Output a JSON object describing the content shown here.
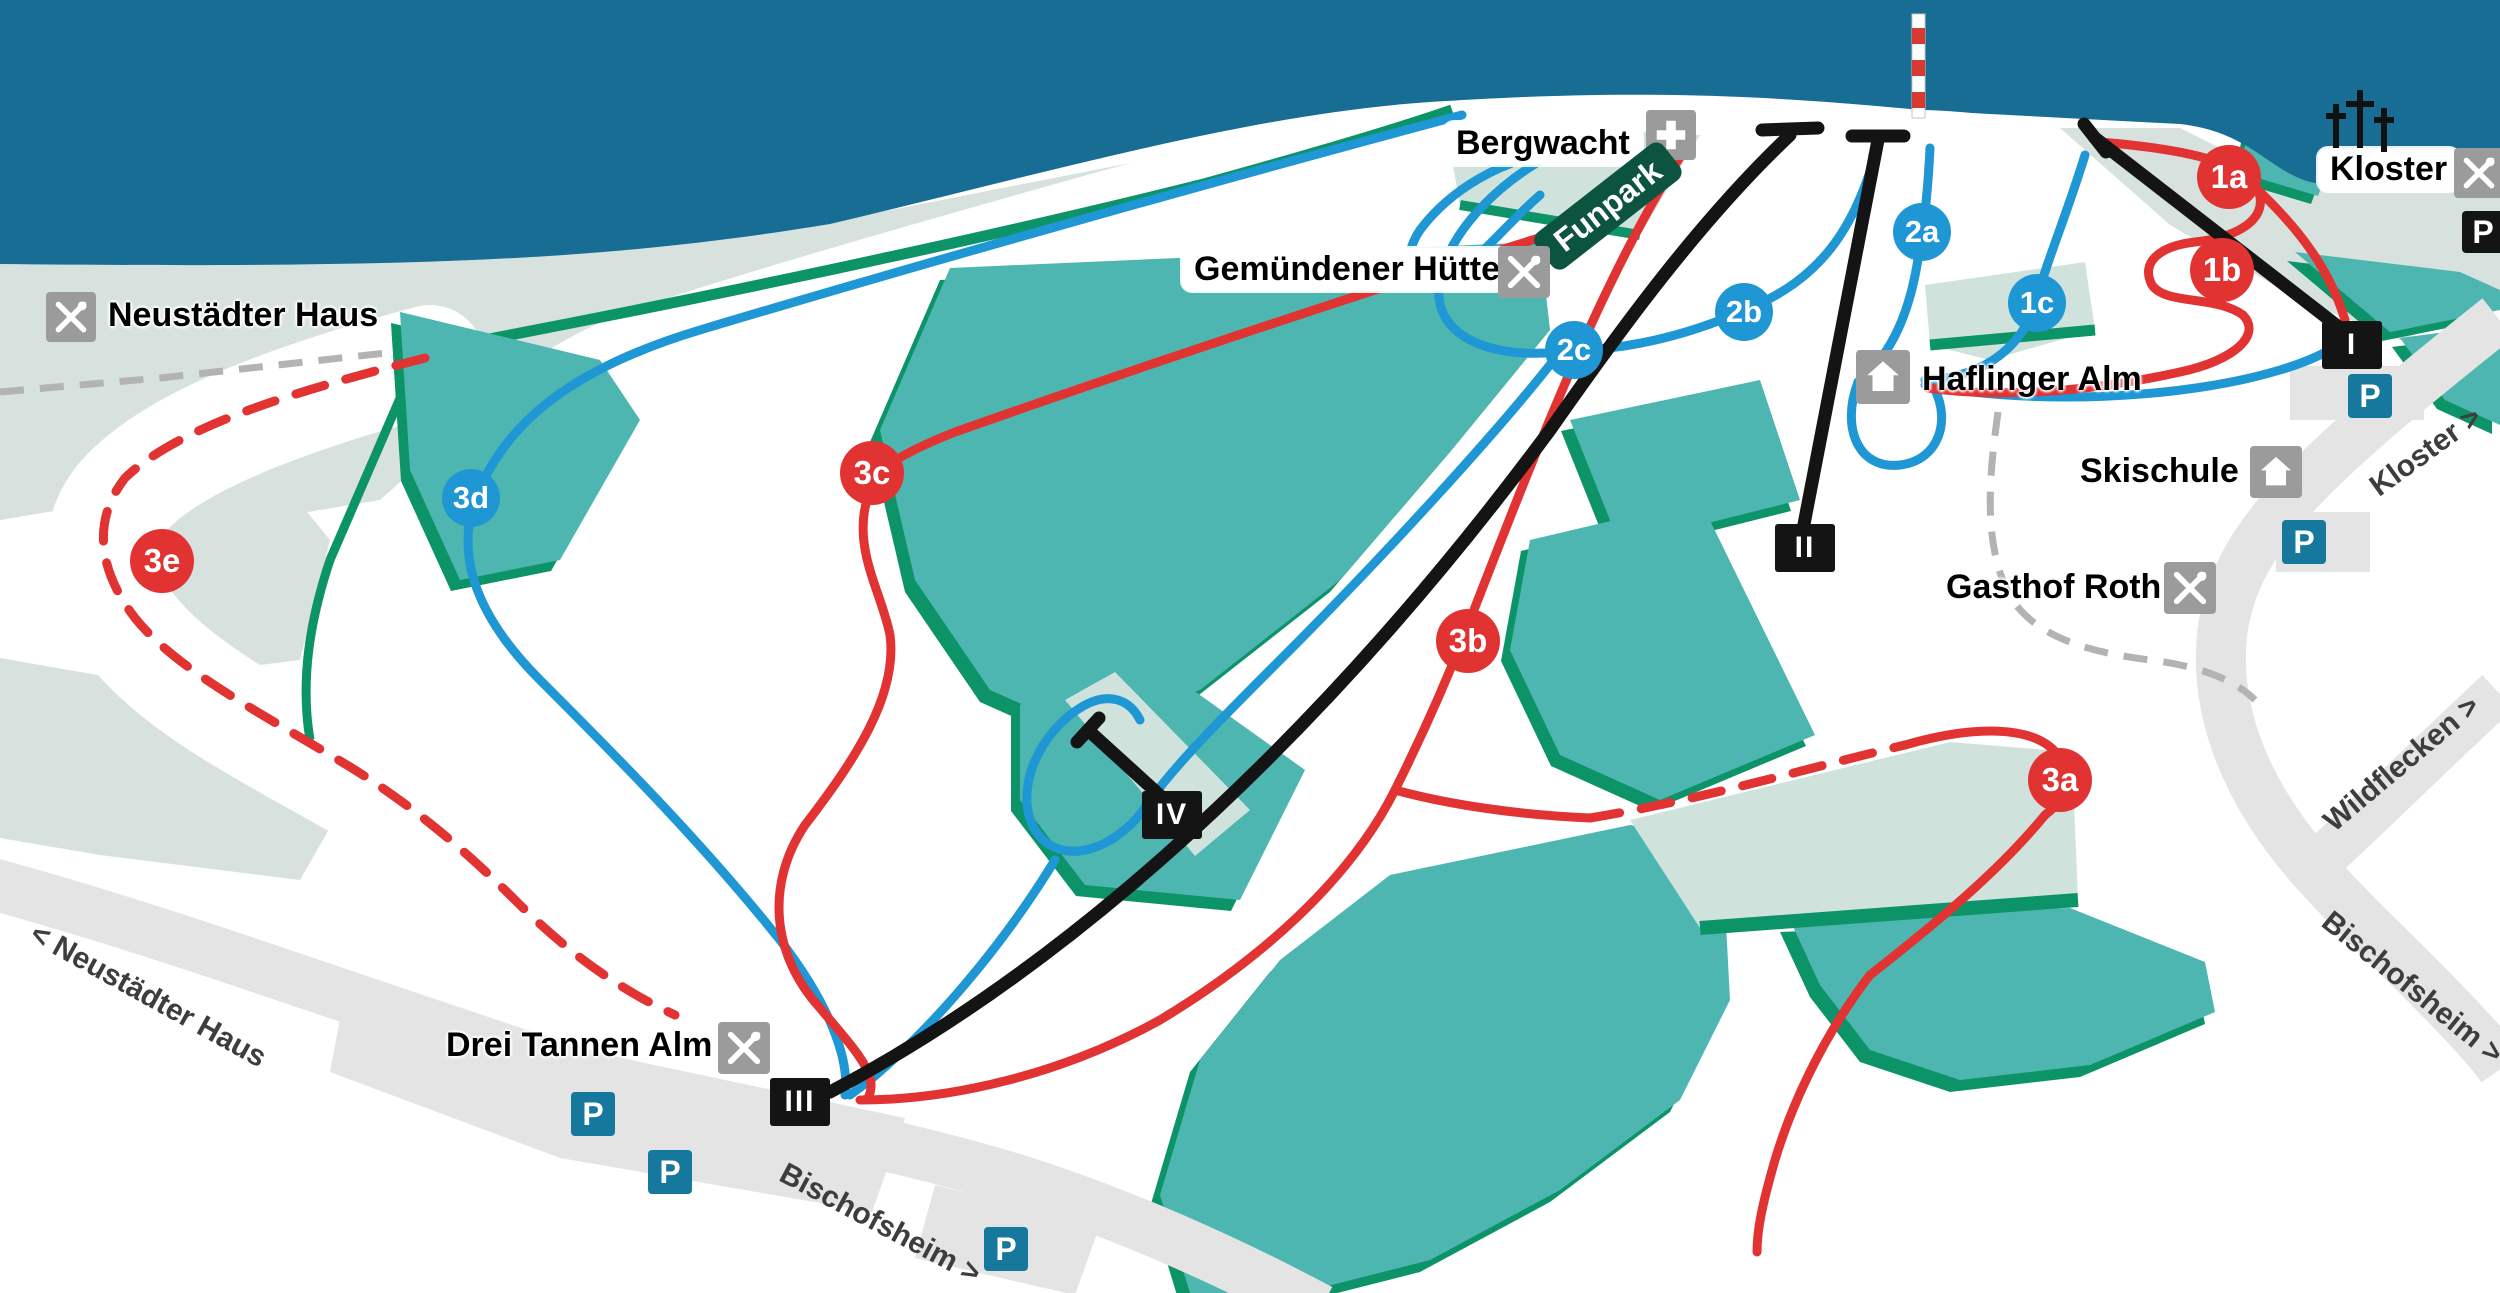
{
  "places": {
    "neustaedter_haus": "Neustädter Haus",
    "bergwacht": "Bergwacht",
    "funpark": "Funpark",
    "gemuendener_huette": "Gemündener Hütte",
    "haflinger_alm": "Haflinger Alm",
    "skischule": "Skischule",
    "gasthof_roth": "Gasthof Roth",
    "kloster": "Kloster",
    "drei_tannen_alm": "Drei Tannen Alm"
  },
  "pistes": [
    {
      "label": "1a",
      "difficulty": "red"
    },
    {
      "label": "1b",
      "difficulty": "red"
    },
    {
      "label": "1c",
      "difficulty": "blue"
    },
    {
      "label": "2a",
      "difficulty": "blue"
    },
    {
      "label": "2b",
      "difficulty": "blue"
    },
    {
      "label": "2c",
      "difficulty": "blue"
    },
    {
      "label": "3a",
      "difficulty": "red"
    },
    {
      "label": "3b",
      "difficulty": "red"
    },
    {
      "label": "3c",
      "difficulty": "red"
    },
    {
      "label": "3d",
      "difficulty": "blue"
    },
    {
      "label": "3e",
      "difficulty": "red"
    }
  ],
  "lifts": [
    {
      "label": "I"
    },
    {
      "label": "II"
    },
    {
      "label": "III"
    },
    {
      "label": "IV"
    }
  ],
  "roads": {
    "neustaedter": "< Neustädter Haus",
    "bischofsheim_bottom": "Bischofsheim >",
    "kloster": "Kloster >",
    "wildflecken": "Wildflecken >",
    "bischofsheim_right": "Bischofsheim >"
  },
  "parking": {
    "label": "P"
  },
  "colors": {
    "sky": "#186d94",
    "plateau": "#d7e2df",
    "clearing": "#cfe3dc",
    "forest": "#4eb6b0",
    "forest_shadow": "#0c9468",
    "piste_easy": "#1e97d4",
    "piste_intermediate": "#e23333",
    "lift": "#141414",
    "road": "#e4e4e4",
    "parking": "#17789e"
  }
}
